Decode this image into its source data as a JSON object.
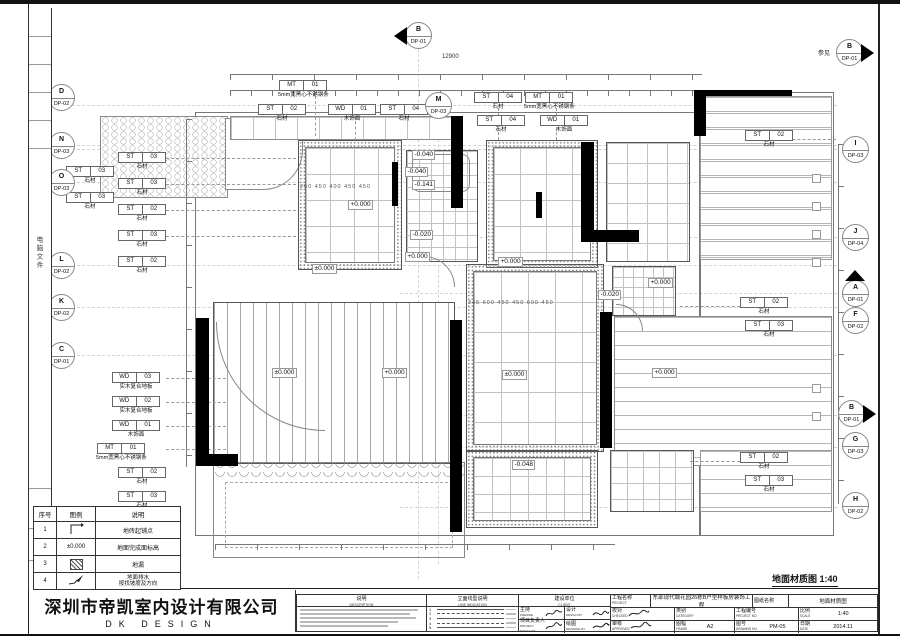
{
  "sheet": {
    "drawing_title": "地面材质图 1:40",
    "spine_text": "电脑文件",
    "see_note": "参见",
    "total_dim": "12900",
    "room_b_dims": "250 450 400 450 450",
    "room_f_dims": "345 600 450 450 600 450"
  },
  "company": {
    "name": "深圳市帝凯室内设计有限公司",
    "logo": "DK DESIGN"
  },
  "legend": {
    "headers": [
      "序号",
      "图例",
      "说明"
    ],
    "rows": [
      {
        "no": "1",
        "symbol": "tile-start",
        "desc": "地砖起铺点",
        "desc2": ""
      },
      {
        "no": "2",
        "symbol": "±0.000",
        "desc": "地面完成面标高",
        "desc2": ""
      },
      {
        "no": "3",
        "symbol": "hatch",
        "desc": "地漏",
        "desc2": ""
      },
      {
        "no": "4",
        "symbol": "slope-arrow",
        "desc": "地面排水",
        "desc2": "按找坡度及方向"
      }
    ]
  },
  "titleblock": {
    "description_label": "说明",
    "description_en": "DESCRIPTION",
    "line_label": "立面线型说明",
    "line_en": "LINE INDICATION",
    "line_rows": [
      "1",
      "2",
      "3",
      "4",
      "5"
    ],
    "client_label": "建设单位",
    "client_en": "CLIENT",
    "preside_label": "主持",
    "preside_en": "PRESIDE",
    "design_label": "设计",
    "design_en": "DESIGN BY",
    "pm_label": "项目负责人",
    "pm_en": "PROJECT MANAGER",
    "drawn_label": "绘图",
    "drawn_en": "DRAWING BY",
    "project_label": "工程名称",
    "project_en": "PROJECT",
    "project_name": "东部现代城花园26栋B户型样板房装饰工程",
    "sheet_label": "图纸名称",
    "sheet_name": "地面材质图",
    "checked_label": "校对",
    "checked_en": "CHECKED",
    "category_label": "类别",
    "category_en": "CATEGORY",
    "projno_label": "工程编号",
    "projno_en": "PROJECT NO.",
    "scale_label": "比例",
    "scale_en": "SCALE",
    "scale": "1:40",
    "approved_label": "审核",
    "approved_en": "APPROVED",
    "frame_label": "图幅",
    "frame_en": "FRAME",
    "frame": "A2",
    "drawno_label": "图号",
    "drawno_en": "DRAWING NO.",
    "drawno": "PM-05",
    "date_label": "日期",
    "date_en": "DATE",
    "date": "2014.11"
  },
  "mk": [
    {
      "l": "D",
      "r": "DP-02"
    },
    {
      "l": "N",
      "r": "DP-03"
    },
    {
      "l": "O",
      "r": "DP-03"
    },
    {
      "l": "L",
      "r": "DP-02"
    },
    {
      "l": "K",
      "r": "DP-02"
    },
    {
      "l": "C",
      "r": "DP-01"
    },
    {
      "l": "B",
      "r": "DP-01"
    },
    {
      "l": "M",
      "r": "DP-03"
    },
    {
      "l": "B",
      "r": "DP-01"
    },
    {
      "l": "I",
      "r": "DP-03"
    },
    {
      "l": "J",
      "r": "DP-04"
    },
    {
      "l": "A",
      "r": "DP-01"
    },
    {
      "l": "F",
      "r": "DP-02"
    },
    {
      "l": "B",
      "r": "DP-01"
    },
    {
      "l": "G",
      "r": "DP-03"
    },
    {
      "l": "H",
      "r": "DP-02"
    }
  ],
  "tags": [
    {
      "a": "ST",
      "b": "03",
      "nm": "石材"
    },
    {
      "a": "ST",
      "b": "03",
      "nm": "石材"
    },
    {
      "a": "ST",
      "b": "03",
      "nm": "石材"
    },
    {
      "a": "ST",
      "b": "03",
      "nm": "石材"
    },
    {
      "a": "ST",
      "b": "02",
      "nm": "石材"
    },
    {
      "a": "ST",
      "b": "03",
      "nm": "石材"
    },
    {
      "a": "ST",
      "b": "02",
      "nm": "石材"
    },
    {
      "a": "WD",
      "b": "03",
      "nm": "实木复合地板"
    },
    {
      "a": "WD",
      "b": "02",
      "nm": "实木复合地板"
    },
    {
      "a": "WD",
      "b": "01",
      "nm": "木饰面"
    },
    {
      "a": "MT",
      "b": "01",
      "nm": "5mm宽黑心不锈钢条"
    },
    {
      "a": "ST",
      "b": "02",
      "nm": "石材"
    },
    {
      "a": "ST",
      "b": "03",
      "nm": "石材"
    },
    {
      "a": "MT",
      "b": "01",
      "nm": "5mm宽黑心不锈钢条"
    },
    {
      "a": "ST",
      "b": "02",
      "nm": "石材"
    },
    {
      "a": "WD",
      "b": "01",
      "nm": "木饰面"
    },
    {
      "a": "ST",
      "b": "04",
      "nm": "石材"
    },
    {
      "a": "ST",
      "b": "04",
      "nm": "石材"
    },
    {
      "a": "ST",
      "b": "04",
      "nm": "石材"
    },
    {
      "a": "MT",
      "b": "01",
      "nm": "5mm宽黑心不锈钢条"
    },
    {
      "a": "WD",
      "b": "01",
      "nm": "木饰面"
    },
    {
      "a": "ST",
      "b": "02",
      "nm": "石材"
    },
    {
      "a": "ST",
      "b": "02",
      "nm": "石材"
    },
    {
      "a": "ST",
      "b": "03",
      "nm": "石材"
    },
    {
      "a": "ST",
      "b": "02",
      "nm": "石材"
    },
    {
      "a": "ST",
      "b": "03",
      "nm": "石材"
    }
  ],
  "lv": [
    {
      "v": "+0.000"
    },
    {
      "v": "-0.040"
    },
    {
      "v": "-0.040"
    },
    {
      "v": "-0.141"
    },
    {
      "v": "-0.020"
    },
    {
      "v": "+0.000"
    },
    {
      "v": "±0.000"
    },
    {
      "v": "±0.000"
    },
    {
      "v": "+0.000"
    },
    {
      "v": "+0.000"
    },
    {
      "v": "±0.000"
    },
    {
      "v": "-0.020"
    },
    {
      "v": "+0.000"
    },
    {
      "v": "+0.000"
    },
    {
      "v": "-0.048"
    }
  ]
}
